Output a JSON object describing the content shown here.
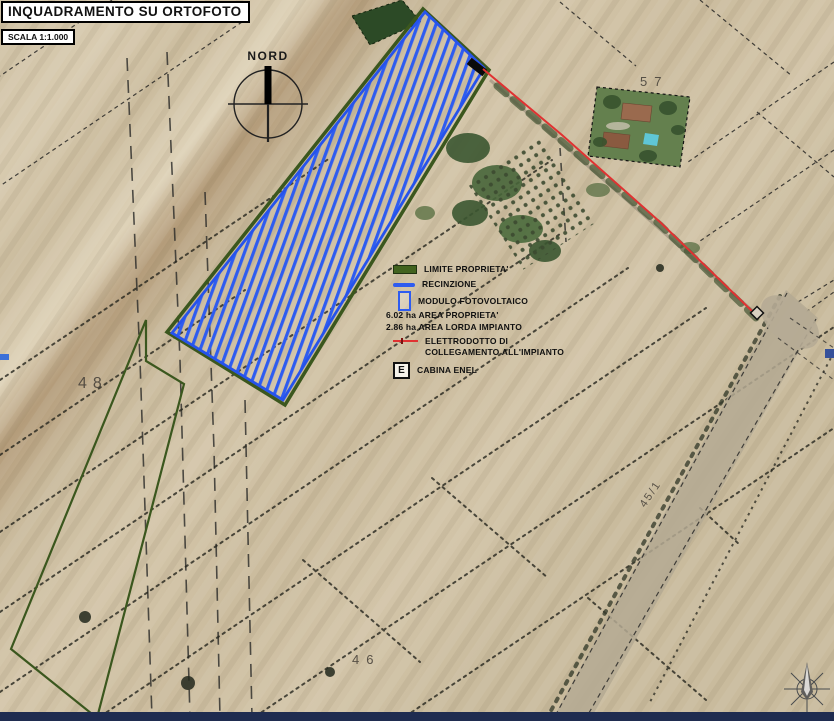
{
  "title": "INQUADRAMENTO SU ORTOFOTO",
  "scale_label": "SCALA 1:1.000",
  "compass": {
    "north_label": "NORD"
  },
  "legend": {
    "limite_label": "LIMITE PROPRIETA'",
    "recinzione_label": "RECINZIONE",
    "modulo_label": "MODULO FOTOVOLTAICO",
    "area_proprieta": "6.02 ha AREA PROPRIETA'",
    "area_lorda": "2.86 ha AREA LORDA IMPIANTO",
    "elettrodotto_line1": "ELETTRODOTTO DI",
    "elettrodotto_line2": "COLLEGAMENTO ALL'IMPIANTO",
    "cabina_symbol": "E",
    "cabina_label": "CABINA ENEL"
  },
  "parcels": {
    "p48": "48",
    "p57": "57",
    "p46": "46",
    "road_label": "45/1"
  },
  "colors": {
    "hatch_blue": "#2e5cf0",
    "fence_blue_border": "#2653ec",
    "property_green": "#3b571e",
    "electroduct_red": "#e03232",
    "ground_tan": "#cfc1a6",
    "bottom_strip_navy": "#1f2c50"
  }
}
